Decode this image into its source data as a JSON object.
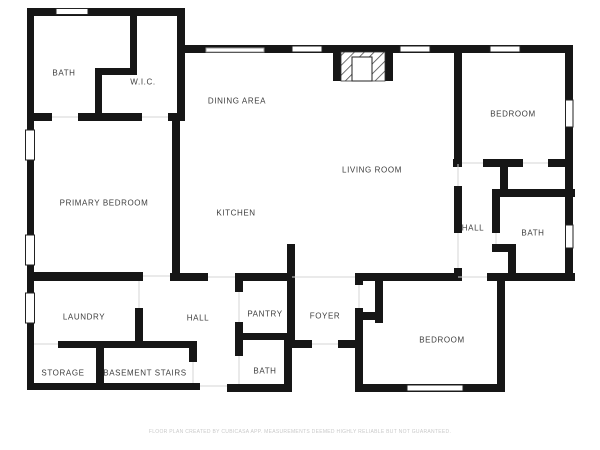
{
  "plan": {
    "footer": "FLOOR PLAN CREATED BY CUBICASA APP. MEASUREMENTS DEEMED HIGHLY RELIABLE BUT NOT GUARANTEED.",
    "colors": {
      "wall": "#161616",
      "label": "#3d3d3d",
      "footer": "#c9c9c9",
      "background": "#ffffff"
    },
    "rooms": [
      {
        "id": "bath-upper-left",
        "label": "BATH"
      },
      {
        "id": "walk-in-closet",
        "label": "W.I.C."
      },
      {
        "id": "dining-area",
        "label": "DINING AREA"
      },
      {
        "id": "primary-bedroom",
        "label": "PRIMARY BEDROOM"
      },
      {
        "id": "kitchen",
        "label": "KITCHEN"
      },
      {
        "id": "living-room",
        "label": "LIVING ROOM"
      },
      {
        "id": "bedroom-upper-right",
        "label": "BEDROOM"
      },
      {
        "id": "hall-right",
        "label": "HALL"
      },
      {
        "id": "bath-right",
        "label": "BATH"
      },
      {
        "id": "laundry",
        "label": "LAUNDRY"
      },
      {
        "id": "hall-lower",
        "label": "HALL"
      },
      {
        "id": "pantry",
        "label": "PANTRY"
      },
      {
        "id": "foyer",
        "label": "FOYER"
      },
      {
        "id": "bedroom-lower-right",
        "label": "BEDROOM"
      },
      {
        "id": "storage",
        "label": "STORAGE"
      },
      {
        "id": "basement-stairs",
        "label": "BASEMENT STAIRS"
      },
      {
        "id": "bath-lower",
        "label": "BATH"
      }
    ]
  }
}
